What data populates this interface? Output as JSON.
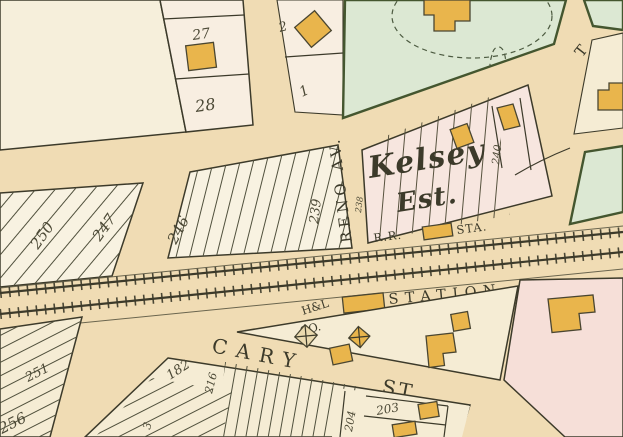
{
  "map": {
    "type": "historical-atlas-plat-map",
    "colors": {
      "paper_street": "#f0dcb4",
      "block_cream": "#f5ecd4",
      "block_light": "#f8f2e1",
      "block_ivory": "#f6efdb",
      "block_pink": "#f7e6df",
      "block_pink_deep": "#f6dfd8",
      "strip_pink": "#f8eee1",
      "block_green": "#dce8d3",
      "building": "#e9b54c",
      "building_pale": "#ead9ae",
      "ink": "#3c3a2a",
      "ink_soft": "#4c4936",
      "green_edge": "#44562f",
      "row_line": "#6a654e"
    },
    "street_labels": {
      "reno_av": "RENO AV.",
      "cary": "CARY",
      "cary_st": "ST.",
      "t_partial": "T"
    },
    "feature_labels": {
      "estate_line1": "Kelsey",
      "estate_line2": "Est.",
      "station": "STATION",
      "rr": "R.R.",
      "rr_sta": "STA.",
      "hl_co_line1": "H&L",
      "hl_co_line2": "CO."
    },
    "lot_numbers": {
      "n27": "27",
      "n28": "28",
      "n2": "2",
      "n1": "1",
      "n250": "250",
      "n247": "247",
      "n246": "246",
      "n239": "239",
      "n238": "238",
      "n240": "240",
      "n251": "251",
      "n256": "256",
      "n182": "182",
      "n216": "216",
      "n3": "3",
      "n204": "204",
      "n203": "203"
    }
  }
}
